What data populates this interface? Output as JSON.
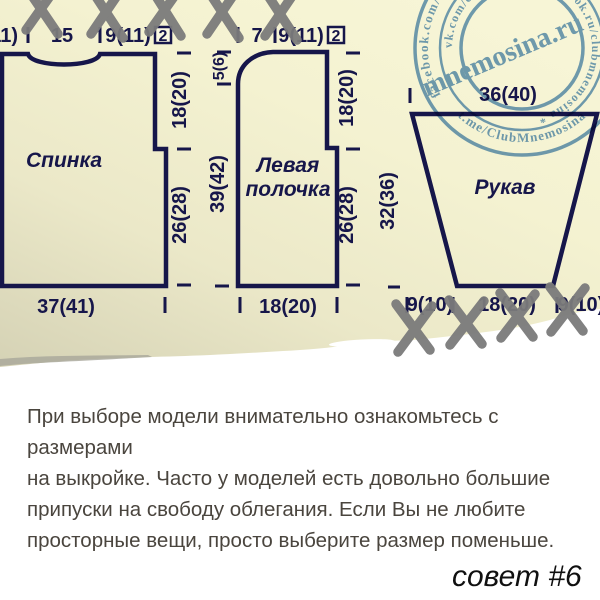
{
  "colors": {
    "paper_cream": "#f6f4d3",
    "paper_shadow": "#d5d2b5",
    "navy": "#16164a",
    "stamp_blue": "#5d92c5",
    "x_gray": "#7b7b7b",
    "note_text": "#4a453e"
  },
  "diagram": {
    "pieces": [
      {
        "name": "Спинка"
      },
      {
        "name": "Левая полочка"
      },
      {
        "name": "Рукав"
      }
    ],
    "labels": [
      {
        "t": "11)",
        "x": 18,
        "y": 42,
        "a": "end"
      },
      {
        "t": "15",
        "x": 62,
        "y": 42
      },
      {
        "t": "9(11)",
        "x": 128,
        "y": 42
      },
      {
        "t": "2",
        "x": 163,
        "y": 41,
        "s": 16
      },
      {
        "t": "7",
        "x": 257,
        "y": 42
      },
      {
        "t": "9(11)",
        "x": 301,
        "y": 42
      },
      {
        "t": "2",
        "x": 336,
        "y": 41,
        "s": 16
      },
      {
        "t": "36(40)",
        "x": 508,
        "y": 101
      },
      {
        "t": "Спинка",
        "x": 64,
        "y": 167,
        "s": 21,
        "i": 1
      },
      {
        "t": "Левая",
        "x": 288,
        "y": 172,
        "s": 21,
        "i": 1
      },
      {
        "t": "полочка",
        "x": 288,
        "y": 196,
        "s": 21,
        "i": 1
      },
      {
        "t": "Рукав",
        "x": 505,
        "y": 194,
        "s": 21,
        "i": 1
      },
      {
        "t": "37(41)",
        "x": 66,
        "y": 313
      },
      {
        "t": "18(20)",
        "x": 288,
        "y": 313
      },
      {
        "t": "9(10)",
        "x": 430,
        "y": 311
      },
      {
        "t": "18(20)",
        "x": 507,
        "y": 311
      },
      {
        "t": "9(10)",
        "x": 581,
        "y": 311
      },
      {
        "t": "18(20)",
        "x": 186,
        "y": 100,
        "r": -90
      },
      {
        "t": "26(28)",
        "x": 186,
        "y": 215,
        "r": -90
      },
      {
        "t": "5(6)",
        "x": 224,
        "y": 66,
        "r": -90,
        "s": 16
      },
      {
        "t": "39(42)",
        "x": 224,
        "y": 184,
        "r": -90
      },
      {
        "t": "18(20)",
        "x": 353,
        "y": 98,
        "r": -90
      },
      {
        "t": "26(28)",
        "x": 353,
        "y": 215,
        "r": -90
      },
      {
        "t": "32(36)",
        "x": 394,
        "y": 201,
        "r": -90
      }
    ]
  },
  "stamp": {
    "center_text": "mnemosina.ru",
    "ring_outer_top": "facebook.com/ClubMnemosina * clubmnemosina/ * ok.ru",
    "ring_outer_bottom": "* t.me/ClubMnemosina *",
    "ring_inner": "vk.com/club_mnemosina * ok.ru/clubmnemosina *"
  },
  "note": {
    "lines": [
      "При выборе модели внимательно ознакомьтесь с размерами",
      "на выкройке. Часто у моделей есть довольно большие",
      "припуски на свободу облегания. Если Вы не любите",
      "просторные вещи, просто выберите размер поменьше."
    ]
  },
  "tip": {
    "label": "совет #6"
  }
}
